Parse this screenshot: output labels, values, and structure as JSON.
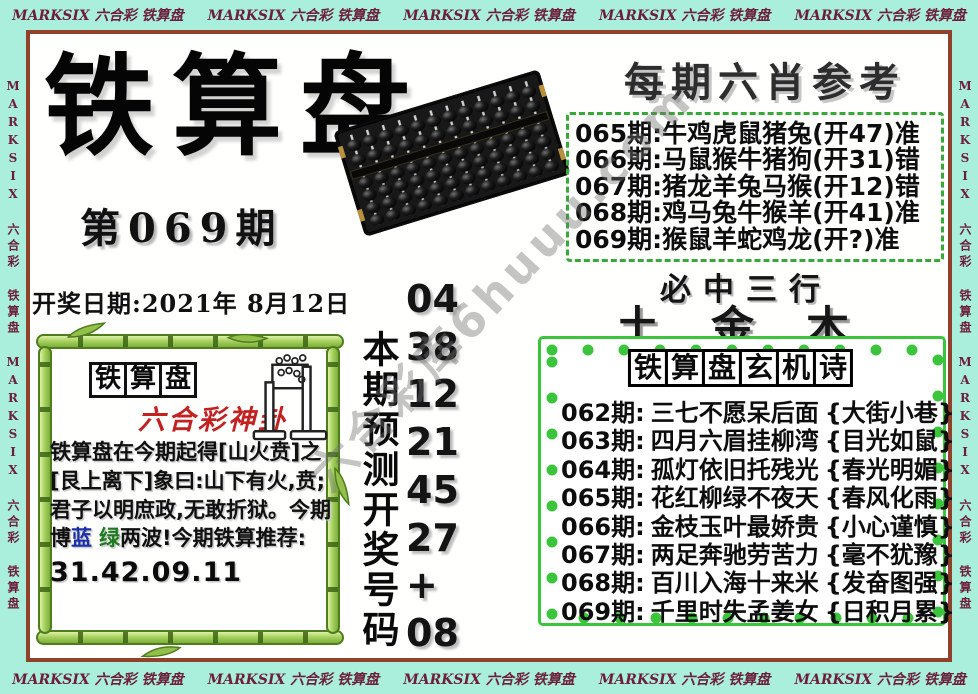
{
  "banner": {
    "repeat_text": "MARKSIX 六合彩 铁算盘"
  },
  "masthead": {
    "title": "铁算盘",
    "issue": "第069期",
    "draw_date": "开奖日期:2021年 8月12日"
  },
  "six_xiao": {
    "title": "每期六肖参考",
    "rows": [
      "065期:牛鸡虎鼠猪兔(开47)准",
      "066期:马鼠猴牛猪狗(开31)错",
      "067期:猪龙羊兔马猴(开12)错",
      "068期:鸡马兔牛猴羊(开41)准",
      "069期:猴鼠羊蛇鸡龙(开?)准"
    ]
  },
  "three_lines": {
    "title": "必中三行",
    "value": "土金木"
  },
  "mystery_poem": {
    "title_chars": [
      "铁",
      "算",
      "盘",
      "玄",
      "机",
      "诗"
    ],
    "rows": [
      {
        "period": "062期:",
        "verse": "三七不愿呆后面",
        "hint": "{大街小巷}"
      },
      {
        "period": "063期:",
        "verse": "四月六眉挂柳湾",
        "hint": "{目光如鼠}"
      },
      {
        "period": "064期:",
        "verse": "孤灯依旧托残光",
        "hint": "{春光明媚}"
      },
      {
        "period": "065期:",
        "verse": "花红柳绿不夜天",
        "hint": "{春风化雨}"
      },
      {
        "period": "066期:",
        "verse": "金枝玉叶最娇贵",
        "hint": "{小心谨慎}"
      },
      {
        "period": "067期:",
        "verse": "两足奔驰劳苦力",
        "hint": "{毫不犹豫}"
      },
      {
        "period": "068期:",
        "verse": "百川入海十来米",
        "hint": "{发奋图强}"
      },
      {
        "period": "069期:",
        "verse": "千里时失孟姜女",
        "hint": "{日积月累}"
      }
    ]
  },
  "prediction": {
    "label": "本期预测开奖号码",
    "numbers": [
      "04",
      "38",
      "12",
      "21",
      "45",
      "27",
      "+",
      "08"
    ]
  },
  "bamboo_box": {
    "header_chars": [
      "铁",
      "算",
      "盘"
    ],
    "subtitle": "六合彩神卦",
    "body_1": "铁算盘在今期起得[山火贲]之[艮上离下]象曰:山下有火,贲;君子以明庶政,无敢折狱。今期博",
    "blue_word": "蓝",
    "green_word": "绿",
    "body_2": "两波!今期铁算推荐:",
    "recommend_numbers": "31.42.09.11"
  },
  "watermark": "六合彩库6huuu.com",
  "colors": {
    "banner_bg": "#a9efdc",
    "banner_text": "#6d1f3a",
    "frame_border": "#91402c",
    "box_green": "#3cc53c",
    "dash_green": "#38a838",
    "accent_red": "#c32222",
    "blue_wave": "#1b2fa8",
    "green_wave": "#1e7a1e"
  }
}
